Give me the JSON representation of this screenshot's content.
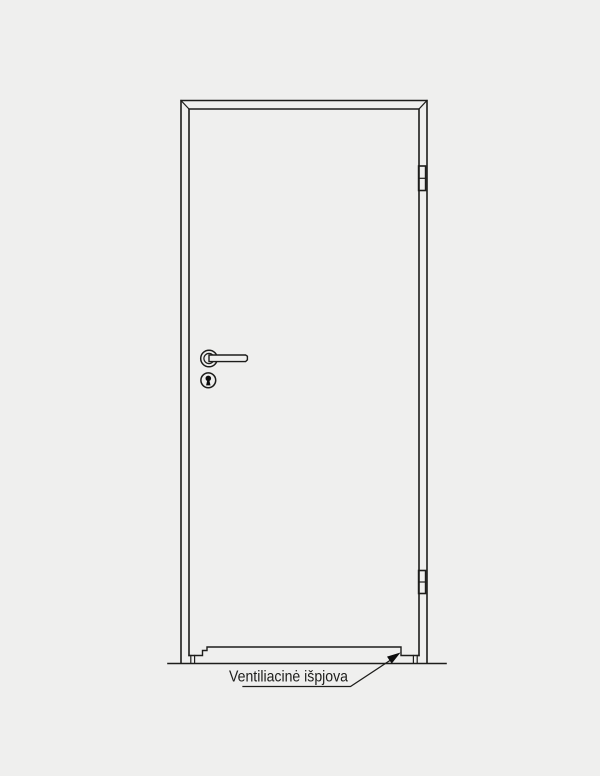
{
  "colors": {
    "background": "#efefee",
    "line": "#1d1d1b",
    "ink": "#0d0d0d"
  },
  "annotation": {
    "ventilation_label": "Ventiliacinė išpjova"
  }
}
